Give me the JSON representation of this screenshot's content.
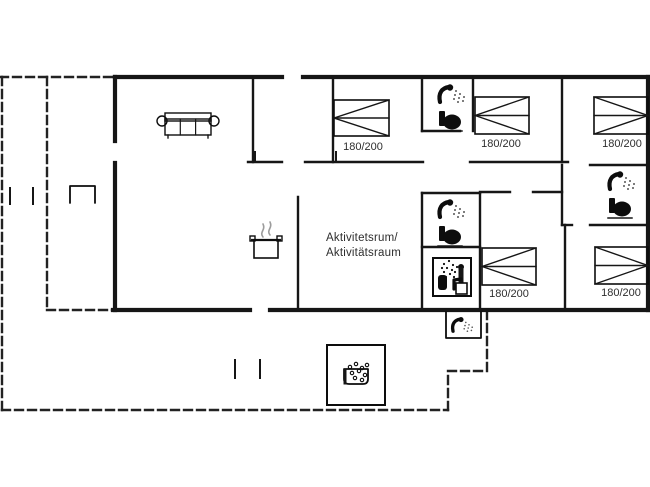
{
  "canvas": {
    "w": 650,
    "h": 487,
    "bg": "#ffffff"
  },
  "style": {
    "wall_color": "#161616",
    "icon_color": "#0d0d0d",
    "label_color": "#2e2e2e",
    "steam_color": "#9c9c9c",
    "dash_color": "#222222",
    "dash_pattern": [
      8,
      5
    ]
  },
  "labels": {
    "activity_room": {
      "line1": "Aktivitetsrum/",
      "line2": "Aktivitätsraum"
    }
  },
  "beds": [
    {
      "x": 334,
      "y": 100,
      "w": 55,
      "h": 36,
      "vertex": "left",
      "label": "180/200",
      "label_cx": 363,
      "label_y": 150
    },
    {
      "x": 475,
      "y": 97,
      "w": 54,
      "h": 37,
      "vertex": "left",
      "label": "180/200",
      "label_cx": 501,
      "label_y": 147
    },
    {
      "x": 594,
      "y": 97,
      "w": 54,
      "h": 37,
      "vertex": "right",
      "label": "180/200",
      "label_cx": 622,
      "label_y": 147
    },
    {
      "x": 482,
      "y": 248,
      "w": 54,
      "h": 37,
      "vertex": "left",
      "label": "180/200",
      "label_cx": 509,
      "label_y": 297
    },
    {
      "x": 595,
      "y": 247,
      "w": 53,
      "h": 37,
      "vertex": "right",
      "label": "180/200",
      "label_cx": 621,
      "label_y": 296
    }
  ],
  "walls": {
    "exterior": [
      [
        115,
        77,
        282,
        77
      ],
      [
        303,
        77,
        648,
        77
      ],
      [
        648,
        77,
        648,
        310
      ],
      [
        648,
        310,
        270,
        310
      ],
      [
        250,
        310,
        113,
        310
      ],
      [
        115,
        310,
        115,
        163
      ],
      [
        115,
        141,
        115,
        77
      ]
    ],
    "interior": [
      [
        253,
        77,
        253,
        162
      ],
      [
        333,
        77,
        333,
        162
      ],
      [
        422,
        77,
        422,
        131
      ],
      [
        473,
        77,
        473,
        131
      ],
      [
        562,
        77,
        562,
        162
      ],
      [
        422,
        131,
        460,
        131
      ],
      [
        248,
        162,
        282,
        162
      ],
      [
        305,
        162,
        423,
        162
      ],
      [
        470,
        162,
        568,
        162
      ],
      [
        590,
        165,
        648,
        165
      ],
      [
        562,
        165,
        562,
        225
      ],
      [
        562,
        225,
        572,
        225
      ],
      [
        590,
        225,
        648,
        225
      ],
      [
        565,
        225,
        565,
        310
      ],
      [
        298,
        197,
        298,
        308
      ],
      [
        422,
        193,
        422,
        310
      ],
      [
        422,
        193,
        480,
        193
      ],
      [
        422,
        247,
        480,
        247
      ],
      [
        480,
        193,
        480,
        310
      ],
      [
        480,
        192,
        510,
        192
      ],
      [
        533,
        192,
        562,
        192
      ]
    ],
    "thin": [
      [
        10,
        188,
        10,
        204
      ],
      [
        33,
        188,
        33,
        204
      ],
      [
        235,
        360,
        235,
        378
      ],
      [
        260,
        360,
        260,
        378
      ],
      [
        255,
        152,
        255,
        162
      ],
      [
        336,
        152,
        336,
        162
      ]
    ]
  },
  "terrace": [
    [
      2,
      77,
      2,
      410
    ],
    [
      0,
      77,
      115,
      77
    ],
    [
      47,
      77,
      47,
      310
    ],
    [
      47,
      310,
      113,
      310
    ],
    [
      2,
      410,
      448,
      410
    ],
    [
      448,
      410,
      448,
      371
    ],
    [
      448,
      371,
      487,
      371
    ],
    [
      487,
      371,
      487,
      313
    ]
  ],
  "icons": [
    {
      "type": "sofa",
      "name": "sofa-icon",
      "x": 157,
      "y": 111
    },
    {
      "type": "pot",
      "name": "stove-pot-icon",
      "x": 250,
      "y": 218
    },
    {
      "type": "shower_toilet",
      "name": "shower-toilet-icon",
      "x": 440,
      "y": 88
    },
    {
      "type": "shower_toilet",
      "name": "shower-toilet-icon",
      "x": 440,
      "y": 203
    },
    {
      "type": "shower_toilet",
      "name": "shower-toilet-icon",
      "x": 610,
      "y": 175
    },
    {
      "type": "sauna",
      "name": "sauna-icon",
      "x": 433,
      "y": 258
    },
    {
      "type": "outdoor_shower",
      "name": "outdoor-shower-icon",
      "x": 446,
      "y": 312
    },
    {
      "type": "hot_tub",
      "name": "hot-tub-icon",
      "x": 327,
      "y": 345
    },
    {
      "type": "grill",
      "name": "grill-icon",
      "x": 70,
      "y": 186
    }
  ]
}
